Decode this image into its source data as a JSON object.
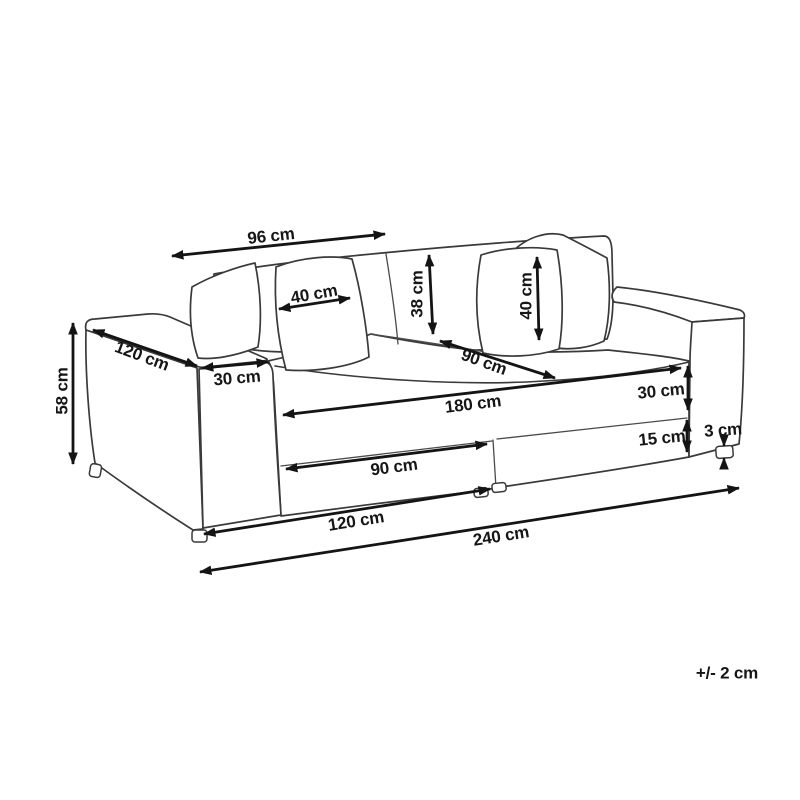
{
  "figure": {
    "kind": "sofa-dimension-diagram",
    "unit": "cm",
    "background_color": "#ffffff",
    "line_color": "#3a3a3a",
    "arrow_color": "#141414",
    "text_color": "#161616"
  },
  "dimensions": [
    {
      "id": "back-width",
      "label": "96 cm"
    },
    {
      "id": "back-pillow-width",
      "label": "40 cm"
    },
    {
      "id": "back-cushion-height",
      "label": "38 cm"
    },
    {
      "id": "back-pillow-height",
      "label": "40 cm"
    },
    {
      "id": "overall-depth",
      "label": "120 cm"
    },
    {
      "id": "armrest-width",
      "label": "30 cm"
    },
    {
      "id": "seat-depth",
      "label": "90 cm"
    },
    {
      "id": "seat-width",
      "label": "180 cm"
    },
    {
      "id": "seat-front-height",
      "label": "30 cm"
    },
    {
      "id": "base-height",
      "label": "15 cm"
    },
    {
      "id": "leg-height",
      "label": "3 cm"
    },
    {
      "id": "seat-module-width",
      "label": "90 cm"
    },
    {
      "id": "half-width",
      "label": "120 cm"
    },
    {
      "id": "overall-width",
      "label": "240 cm"
    },
    {
      "id": "overall-height",
      "label": "58 cm"
    },
    {
      "id": "tolerance",
      "label": "+/- 2 cm"
    }
  ]
}
